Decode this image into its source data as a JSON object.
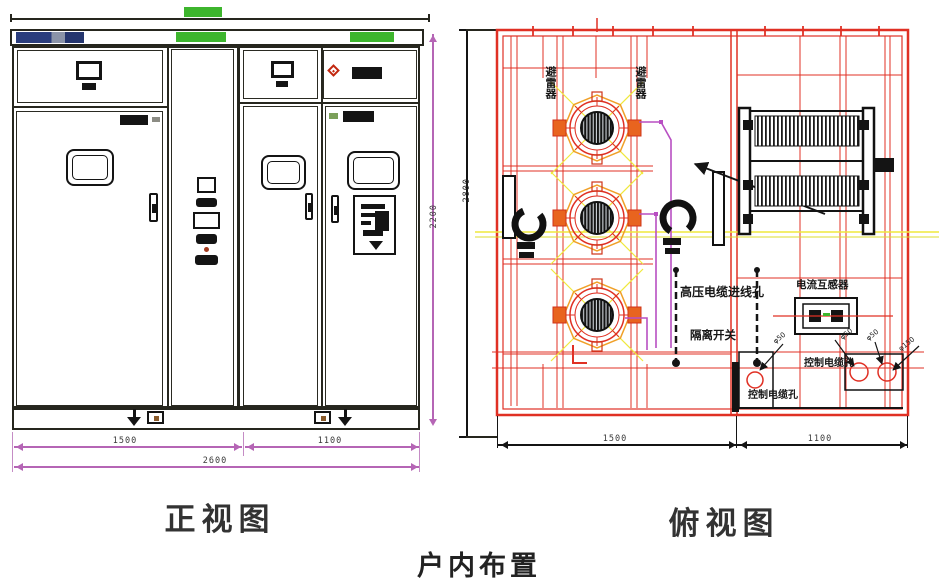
{
  "page": {
    "caption": "户内布置"
  },
  "front_view": {
    "title": "正视图",
    "dims": {
      "left_width": "1500",
      "right_width": "1100",
      "total_width": "2600",
      "height": "2200"
    }
  },
  "top_view": {
    "title": "俯视图",
    "dims": {
      "left_width": "1500",
      "right_width": "1100",
      "depth": "2800"
    },
    "labels": {
      "arrester_left": "避雷器",
      "arrester_right": "避雷器",
      "cable_entry": "高压电缆进线孔",
      "isolator": "隔离开关",
      "current_transformer": "电流互感器",
      "control_hole_1": "控制电缆孔",
      "control_hole_2": "控制电缆孔",
      "hole_dia_1": "φ50",
      "hole_dia_2": "φ50",
      "hole_dia_3": "φ50",
      "hole_dia_4": "φ150"
    }
  },
  "colors": {
    "front_line": "#26261e",
    "dim_magenta": "#b565b5",
    "green_strip": "#3db52d",
    "top_view_red": "#e03024",
    "accent_yellow": "#efe93c",
    "accent_orange": "#f0a028",
    "routing_magenta": "#b84fc2",
    "nameplate_blue": "#2a3d7d"
  }
}
